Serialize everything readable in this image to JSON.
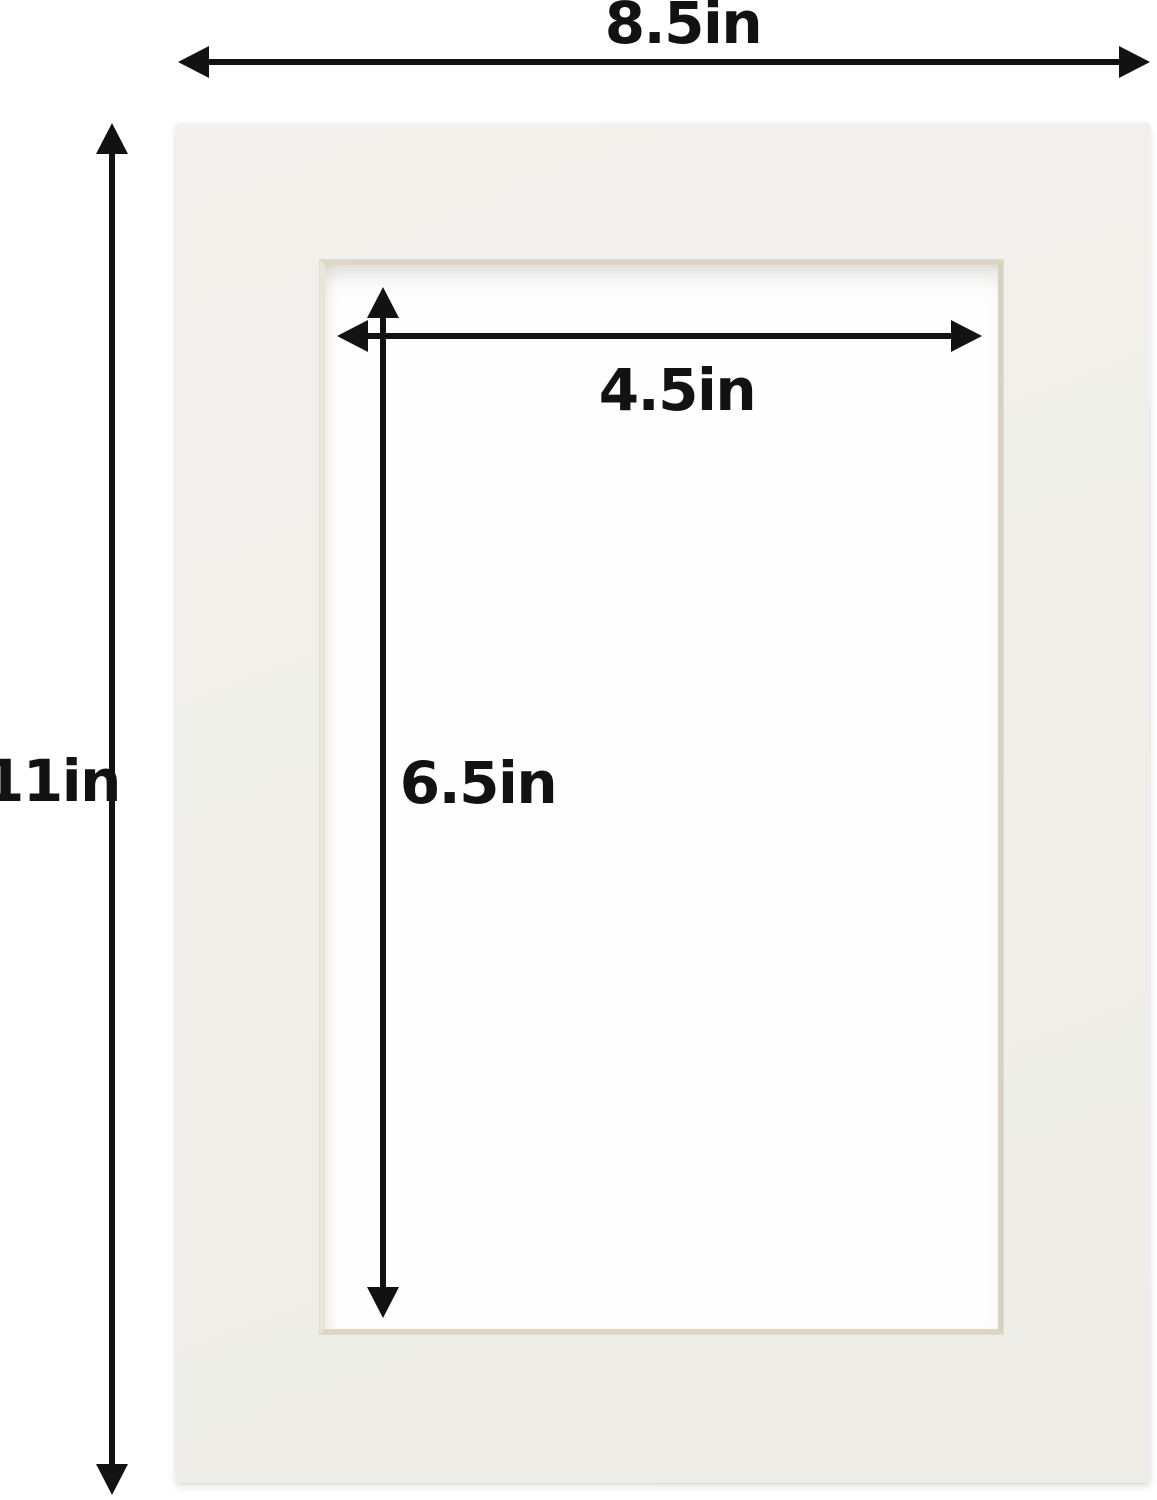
{
  "diagram": {
    "labels": {
      "outer_width": "8.5in",
      "outer_height": "11in",
      "opening_width": "4.5in",
      "opening_height": "6.5in"
    },
    "colors": {
      "background": "#ffffff",
      "mat_surface": "#f0efea",
      "bevel": "#ddd6c3",
      "arrow_and_text": "#121212"
    }
  }
}
